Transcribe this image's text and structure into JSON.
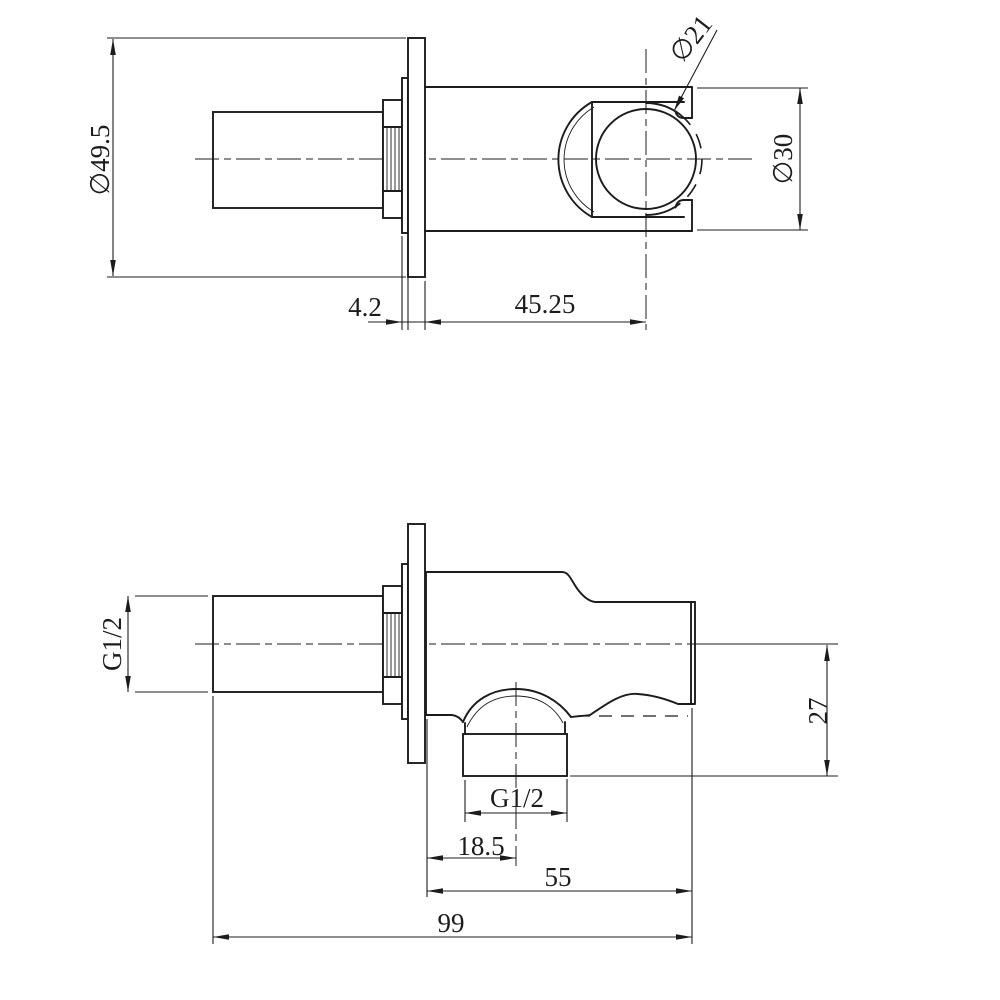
{
  "colors": {
    "background": "#ffffff",
    "line": "#1c1c1c"
  },
  "top_view": {
    "flange_diameter": "∅49.5",
    "flange_thickness": "4.2",
    "holder_offset": "45.25",
    "holder_inner_diameter": "∅21",
    "body_diameter": "∅30"
  },
  "bottom_view": {
    "inlet_thread": "G1/2",
    "outlet_thread": "G1/2",
    "outlet_drop": "27",
    "outlet_offset": "18.5",
    "body_length": "55",
    "overall_length": "99"
  }
}
